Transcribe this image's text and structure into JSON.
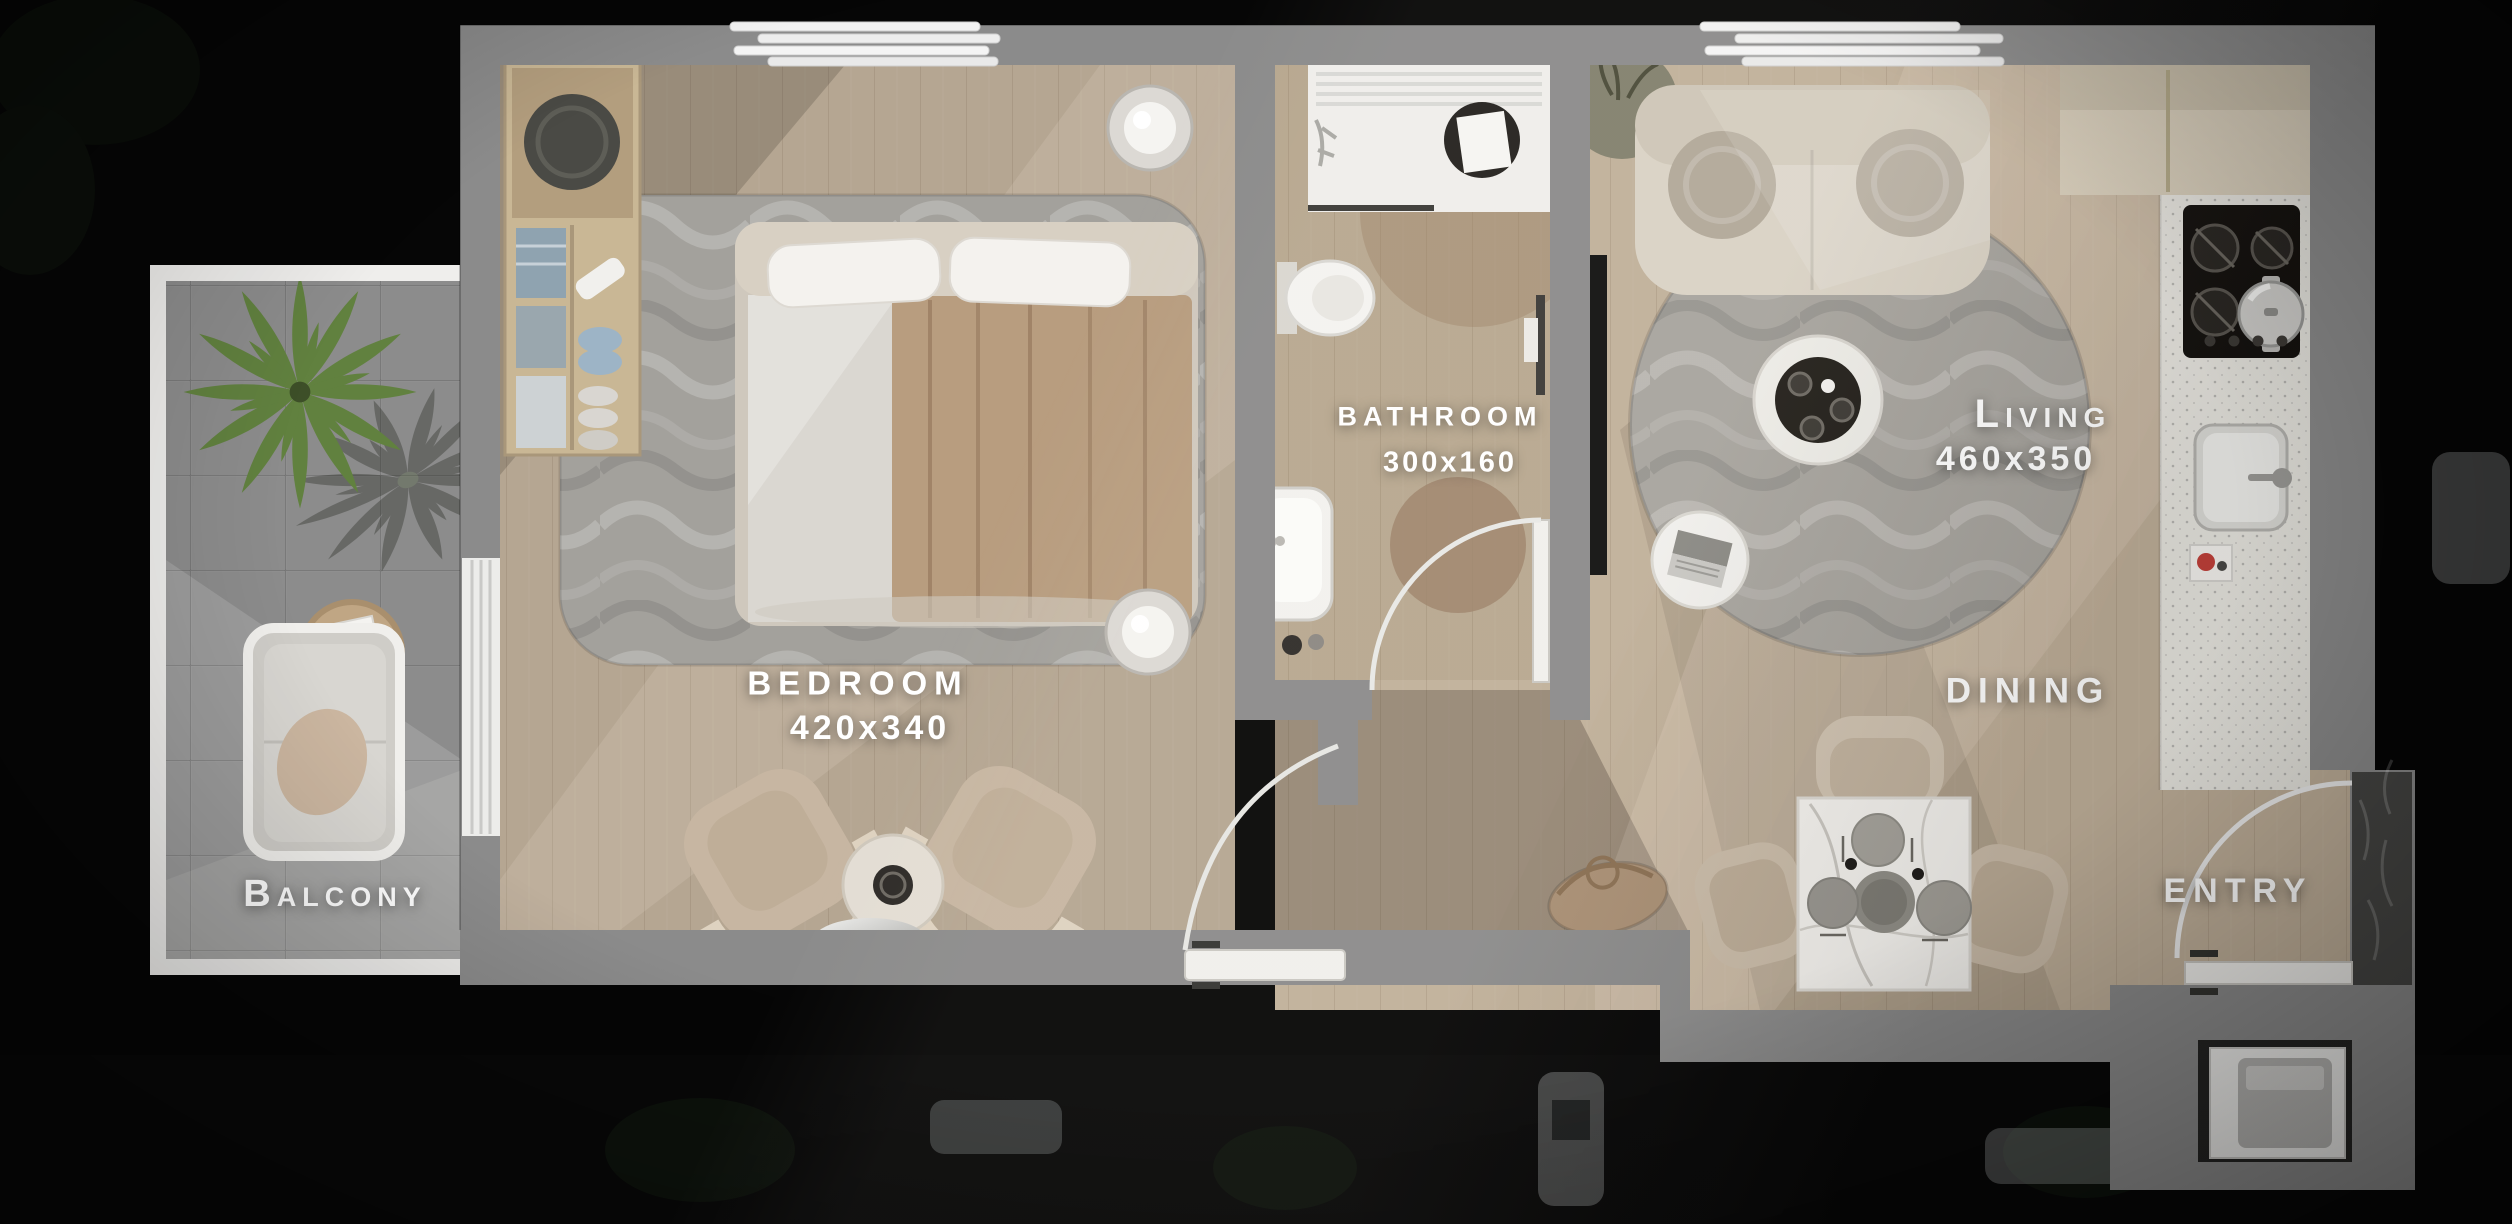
{
  "page": {
    "background": "#040404"
  },
  "plan": {
    "rooms": [
      {
        "id": "bedroom",
        "label": "BEDROOM",
        "dimensions": "420x340"
      },
      {
        "id": "bathroom",
        "label": "BATHROOM",
        "dimensions": "300x160"
      },
      {
        "id": "living",
        "label": "Living",
        "dimensions": "460x350"
      },
      {
        "id": "dining",
        "label": "DINING"
      },
      {
        "id": "entry",
        "label": "ENTRY"
      },
      {
        "id": "balcony",
        "label": "Balcony"
      }
    ],
    "colors": {
      "wall": "#8b8b8b",
      "wood_floor": "#c0b09a",
      "bedroom_floor": "#b5a692",
      "bathroom_floor": "#b7a78f",
      "balcony_tile": "#9c9c9c",
      "kitchen_counter": "#e8e6e0",
      "kitchen_cabinet": "#d8cebb",
      "label_text": "#ffffff"
    }
  }
}
